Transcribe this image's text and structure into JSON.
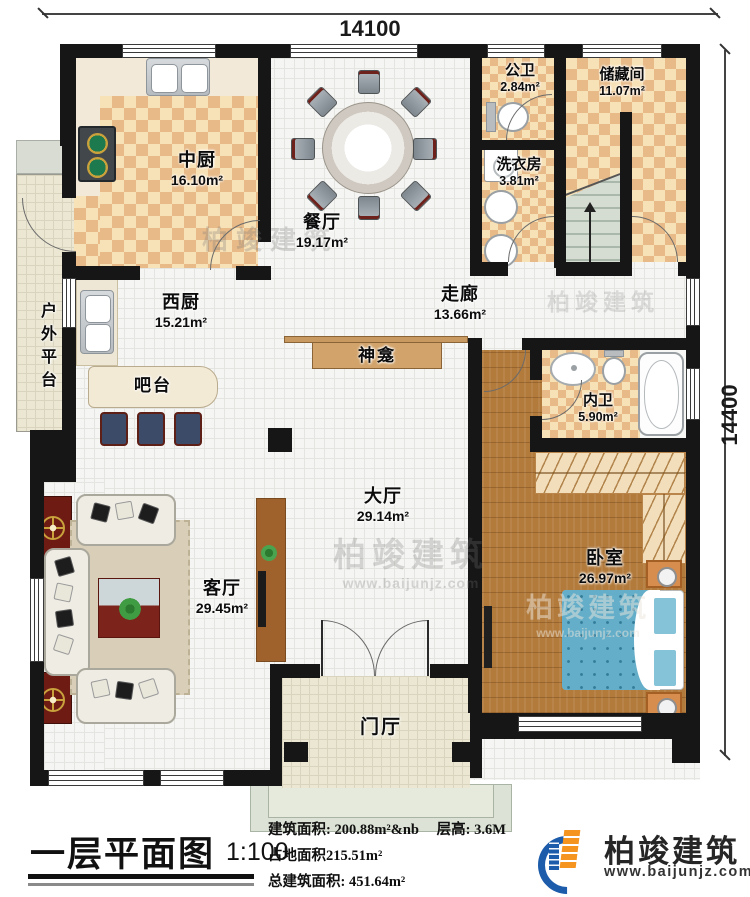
{
  "plan": {
    "dim_top": "14100",
    "dim_right": "14400"
  },
  "rooms": [
    {
      "name": "中厨",
      "area": "16.10m²"
    },
    {
      "name": "餐厅",
      "area": "19.17m²"
    },
    {
      "name": "公卫",
      "area": "2.84m²"
    },
    {
      "name": "储藏间",
      "area": "11.07m²"
    },
    {
      "name": "洗衣房",
      "area": "3.81m²"
    },
    {
      "name": "西厨",
      "area": "15.21m²"
    },
    {
      "name": "走廊",
      "area": "13.66m²"
    },
    {
      "name": "神龛",
      "area": ""
    },
    {
      "name": "吧台",
      "area": ""
    },
    {
      "name": "户外平台",
      "area": ""
    },
    {
      "name": "内卫",
      "area": "5.90m²"
    },
    {
      "name": "大厅",
      "area": "29.14m²"
    },
    {
      "name": "卧室",
      "area": "26.97m²"
    },
    {
      "name": "客厅",
      "area": "29.45m²"
    },
    {
      "name": "门厅",
      "area": ""
    }
  ],
  "title_block": {
    "title": "一层平面图",
    "scale": "1:100",
    "stat1_label": "建筑面积:",
    "stat1_value": "200.88m²",
    "stat2_label": "层高:",
    "stat2_value": "3.6M",
    "stat3_label": "占地面积",
    "stat3_value": "215.51m²",
    "stat4_label": "总建筑面积:",
    "stat4_value": "451.64m²"
  },
  "logo": {
    "name": "柏竣建筑",
    "url": "www.baijunjz.com"
  },
  "watermark": {
    "text": "柏竣建筑",
    "url": "www.baijunjz.com"
  }
}
